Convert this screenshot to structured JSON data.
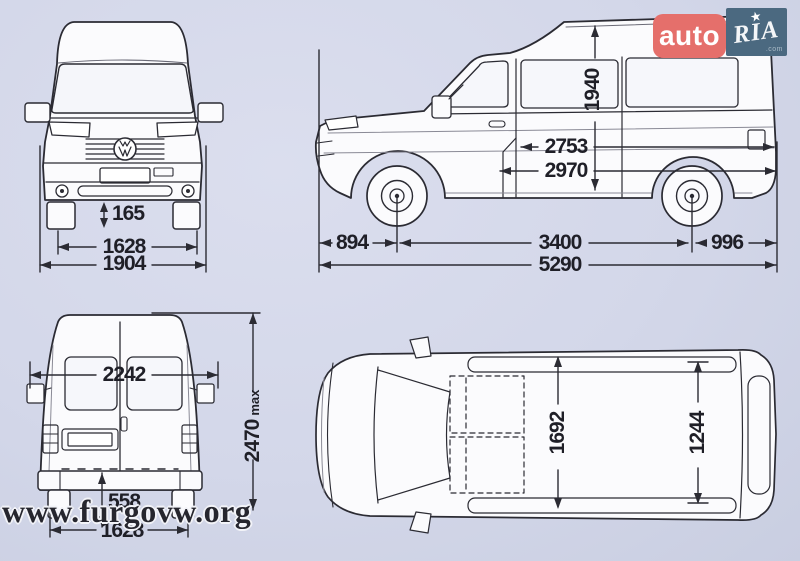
{
  "canvas": {
    "background": "#d3d7e9",
    "line_color": "#2b2b33"
  },
  "branding": {
    "auto_label": "auto",
    "ria_label": "RIA",
    "ria_star_icon": "★",
    "ria_domain": ".com",
    "site_watermark": "www.furgovw.org"
  },
  "front_view": {
    "ground_clearance": "165",
    "track_width": "1628",
    "overall_width": "1904"
  },
  "side_view": {
    "roof_interior_height": "1940",
    "cargo_length_upper": "2753",
    "cargo_length_lower": "2970",
    "front_overhang": "894",
    "wheelbase": "3400",
    "rear_overhang": "996",
    "overall_length": "5290"
  },
  "rear_view": {
    "width_with_mirrors": "2242",
    "overall_height_value": "2470",
    "overall_height_suffix": "max",
    "loading_sill_height": "558",
    "rear_track": "1628"
  },
  "top_view": {
    "interior_width": "1692",
    "width_between_arches": "1244"
  }
}
